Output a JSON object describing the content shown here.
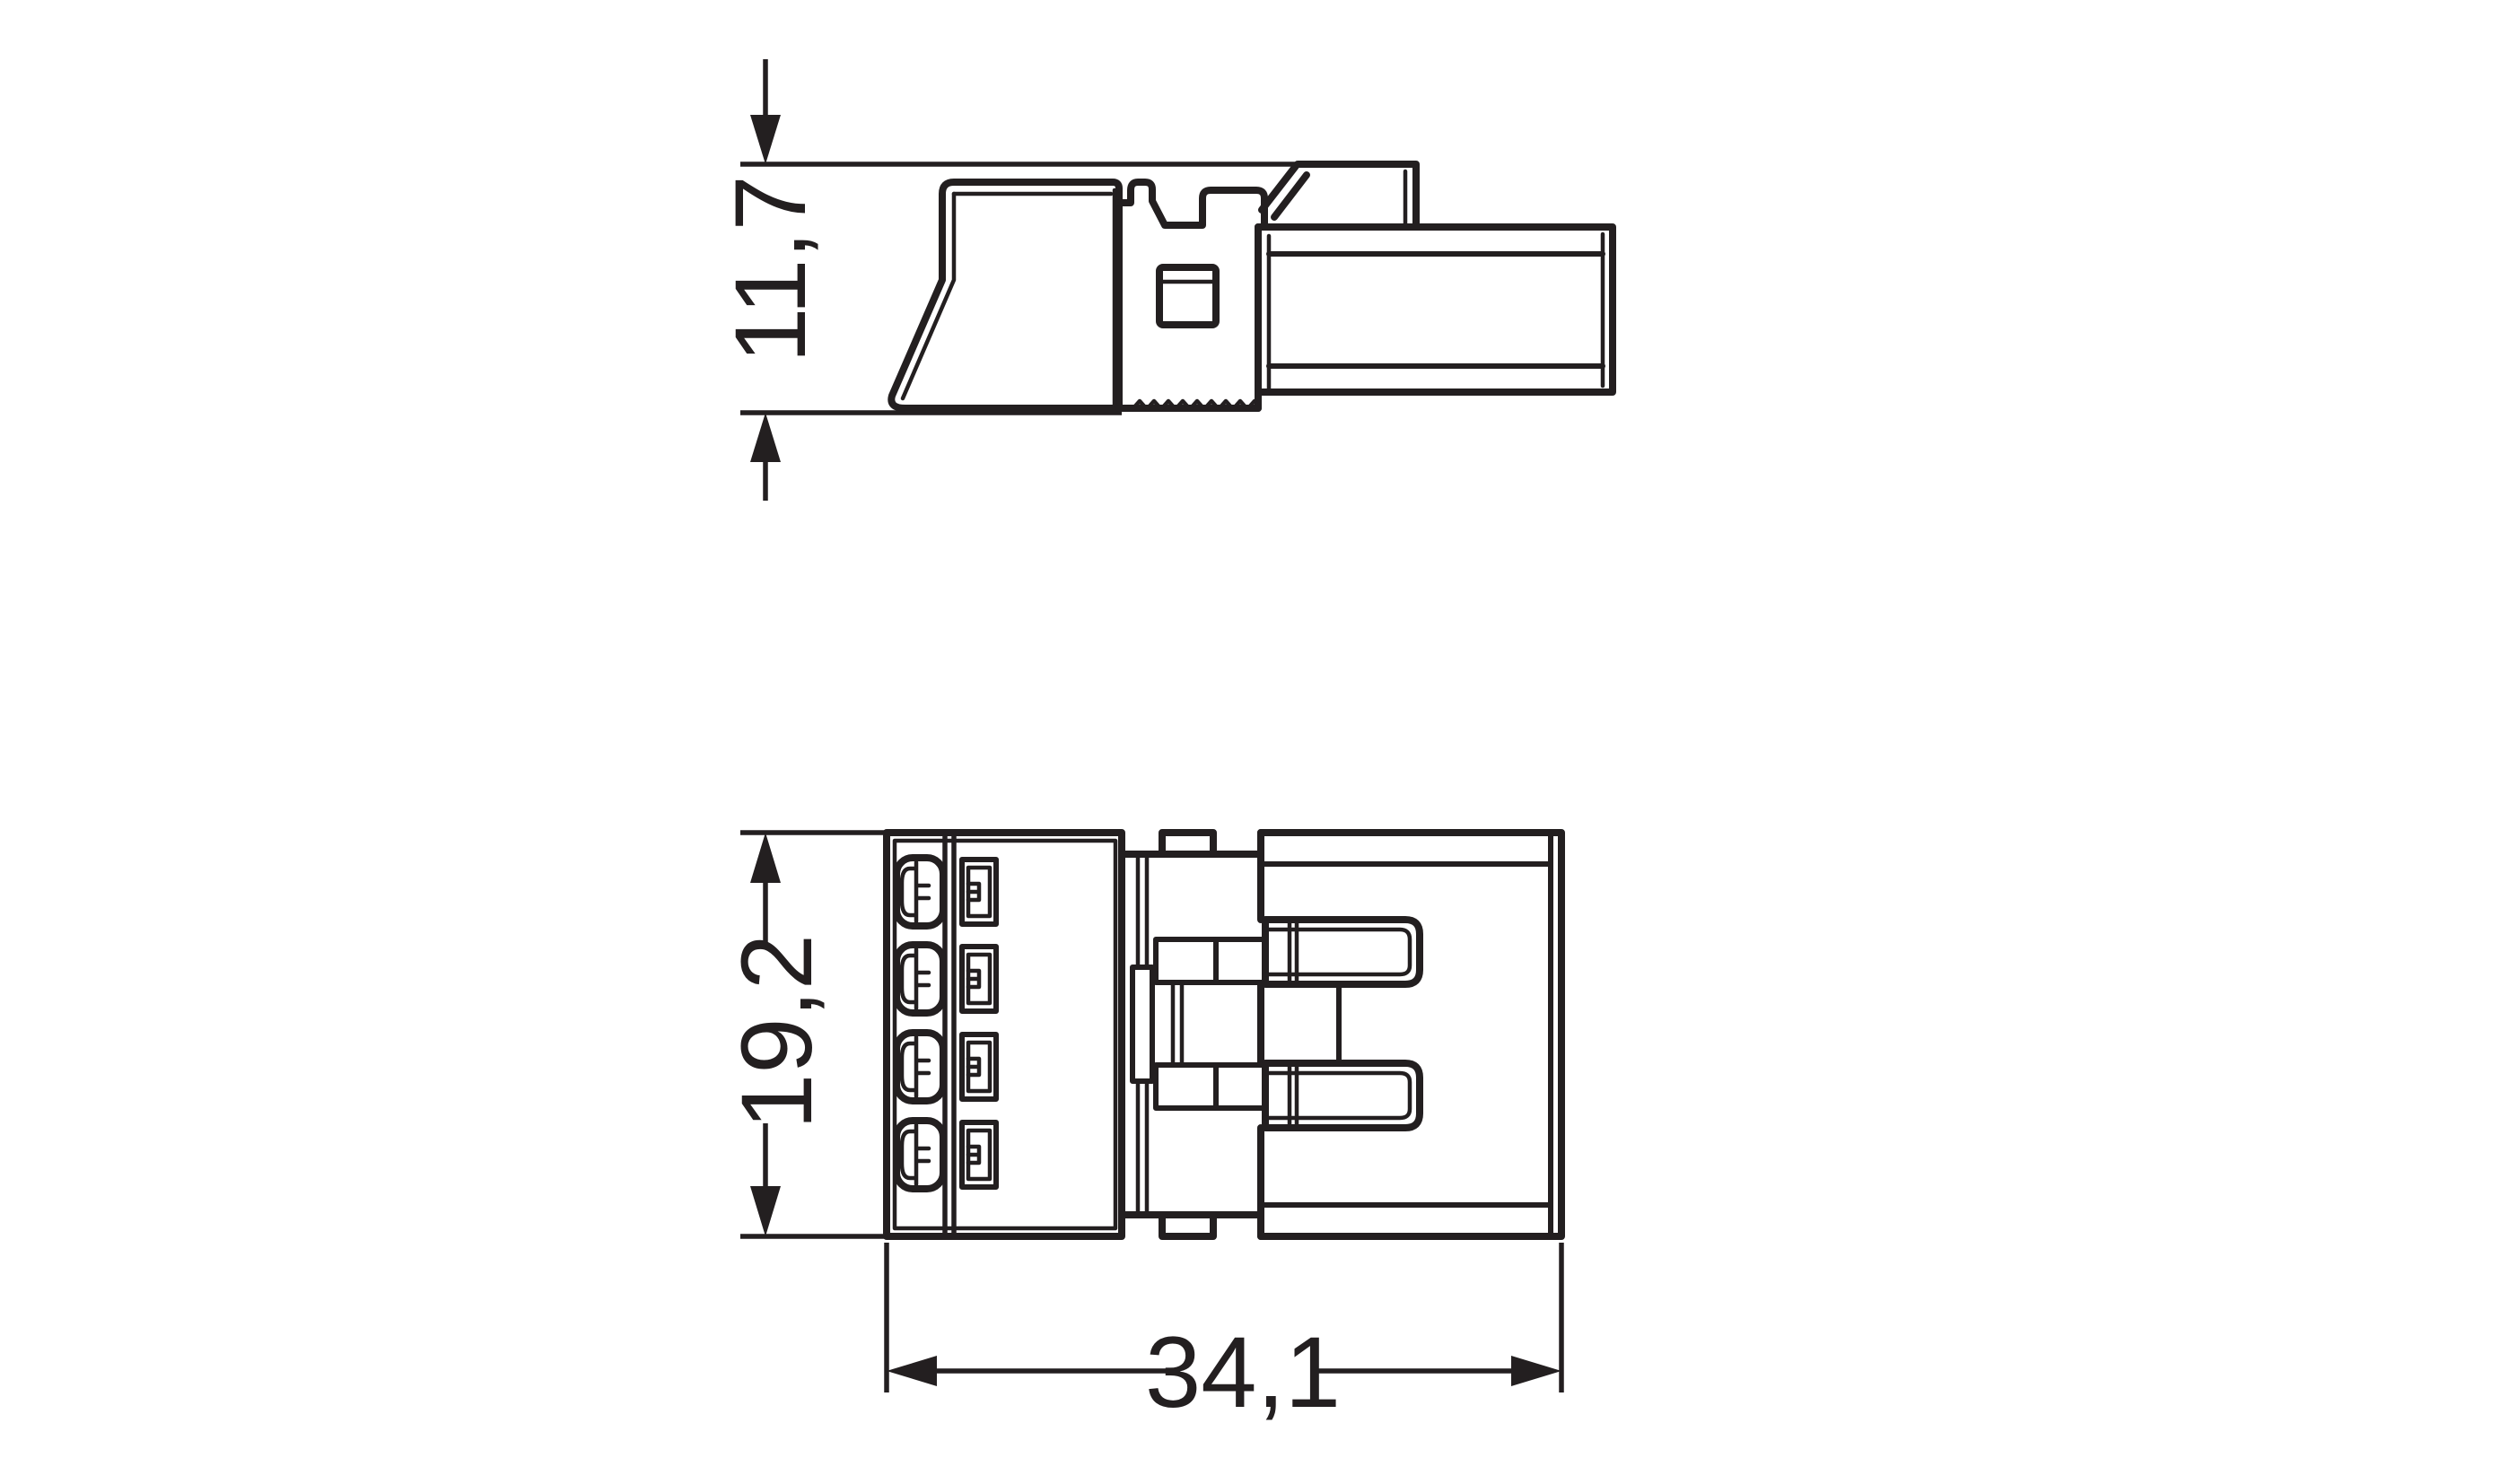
{
  "page": {
    "background_color": "#ffffff",
    "line_color": "#231f20"
  },
  "drawing": {
    "dimensions": {
      "side_height_mm": "11,7",
      "front_height_mm": "19,2",
      "front_width_mm": "34,1"
    }
  }
}
